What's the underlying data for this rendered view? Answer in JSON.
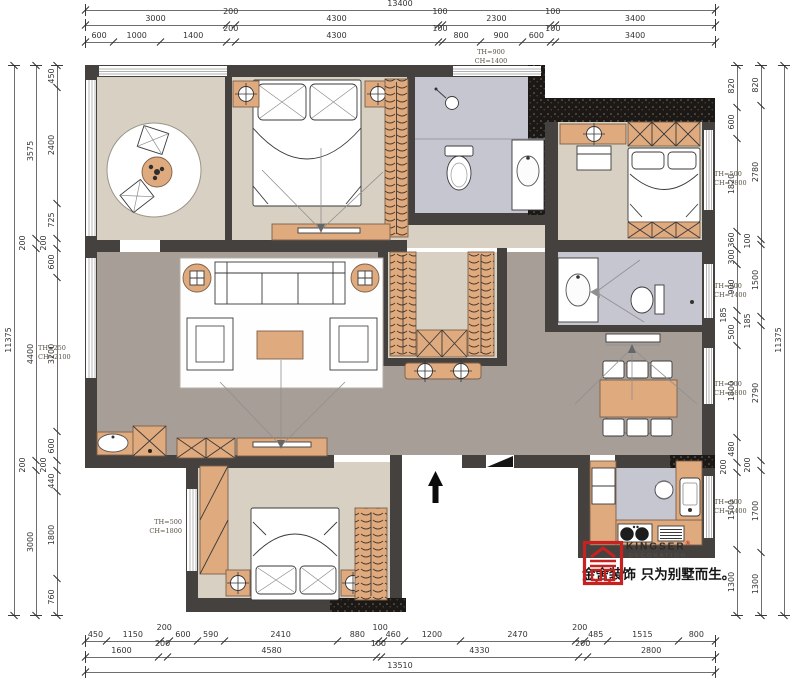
{
  "brand": {
    "name": "KINGSER",
    "reg": "®",
    "sub": "DECORATION",
    "slogan": "金舍装饰 只为别墅而生。",
    "seal_color": "#c62222"
  },
  "annotations": {
    "top_window": [
      "TH=900",
      "CH=1400"
    ],
    "left_window": [
      "TH=250",
      "CH=2100"
    ],
    "right_window_1": [
      "TH=500",
      "CH=1800"
    ],
    "right_window_2": [
      "TH=900",
      "CH=1400"
    ],
    "right_window_3": [
      "TH=500",
      "CH=1800"
    ],
    "right_window_4": [
      "TH=900",
      "CH=1400"
    ],
    "bottom_left_window": [
      "TH=500",
      "CH=1800"
    ]
  },
  "dimensions": {
    "top": {
      "overall": [
        "13400"
      ],
      "row2": [
        "3000",
        "200",
        "4300",
        "100",
        "2300",
        "100",
        "3400"
      ],
      "row3": [
        "600",
        "1000",
        "1400",
        "200",
        "4300",
        "100",
        "800",
        "900",
        "600",
        "100",
        "3400"
      ]
    },
    "bottom": {
      "row1": [
        "450",
        "1150",
        "200",
        "600",
        "590",
        "2410",
        "880",
        "100",
        "460",
        "1200",
        "2470",
        "200",
        "485",
        "1515",
        "800"
      ],
      "row2": [
        "1600",
        "200",
        "4580",
        "100",
        "4330",
        "200",
        "2800"
      ],
      "overall": [
        "13510"
      ]
    },
    "left": {
      "overall": [
        "11375"
      ],
      "col2": [
        "3575",
        "200",
        "4400",
        "200",
        "3000"
      ],
      "col3": [
        "450",
        "2400",
        "725",
        "200",
        "600",
        "3200",
        "600",
        "200",
        "440",
        "1800",
        "760"
      ]
    },
    "right": {
      "col1": [
        "820",
        "600",
        "1820",
        "360",
        "300",
        "900",
        "185",
        "500",
        "1800",
        "480",
        "200",
        "1500",
        "1300"
      ],
      "col2": [
        "820",
        "2780",
        "100",
        "1500",
        "185",
        "2790",
        "200",
        "1700",
        "1300"
      ],
      "overall": [
        "11375"
      ]
    }
  },
  "colors": {
    "wall": "#45413e",
    "wall_new": "#1b1815",
    "floor_beige": "#d8d1c3",
    "floor_taupe": "#a79e97",
    "floor_lavender": "#c6c6d1",
    "furniture_orange": "#e0aa7f",
    "logo_red": "#c62222"
  }
}
